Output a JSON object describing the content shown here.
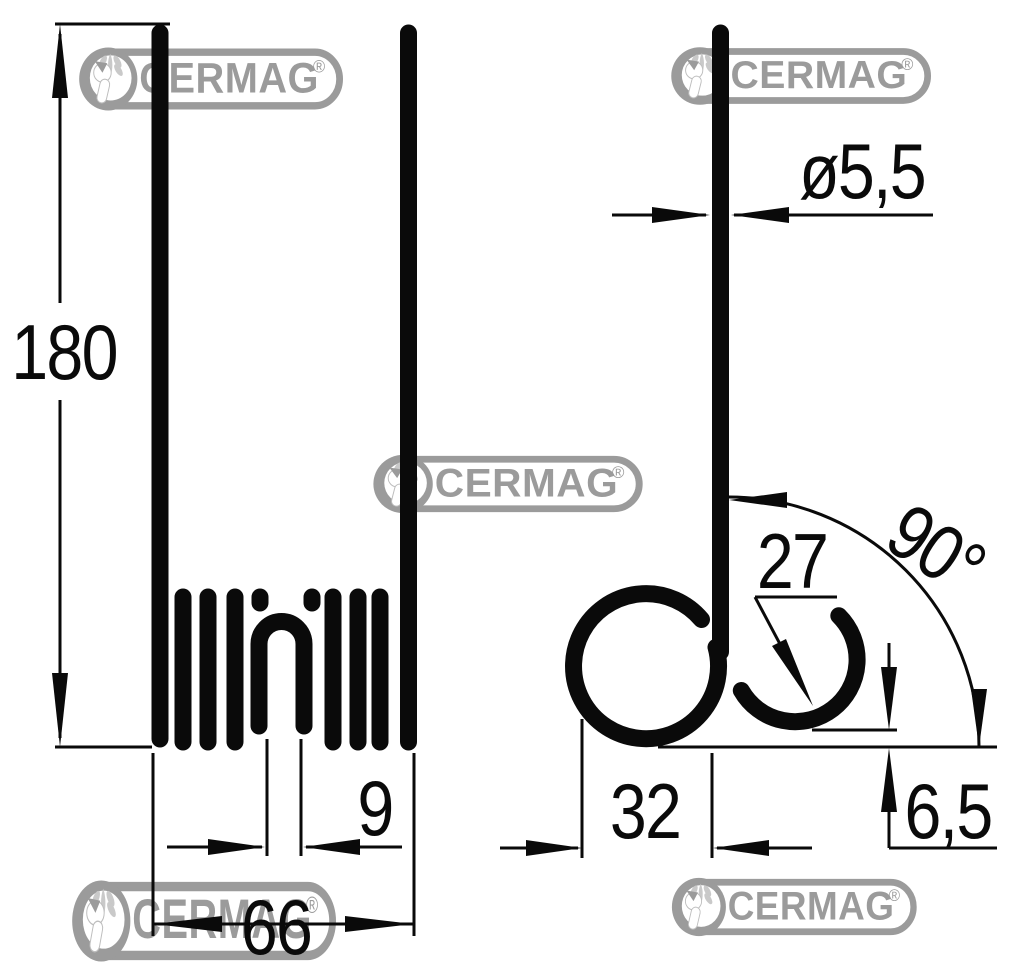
{
  "watermark": {
    "text": "CERMAG",
    "registered": "®"
  },
  "dimensions": {
    "tine_length": {
      "label": "180"
    },
    "wire_diameter": {
      "label": "ø5,5"
    },
    "hook_radius": {
      "label": "27"
    },
    "bend_angle": {
      "label": "90°"
    },
    "loop_width": {
      "label": "9"
    },
    "overall_width": {
      "label": "66"
    },
    "coil_width": {
      "label": "32"
    },
    "hook_clearance": {
      "label": "6,5"
    }
  },
  "colors": {
    "line": "#0a0a0a",
    "background": "#ffffff",
    "watermark_gray": "#9b9b9b",
    "watermark_light": "#c9c9c9"
  }
}
